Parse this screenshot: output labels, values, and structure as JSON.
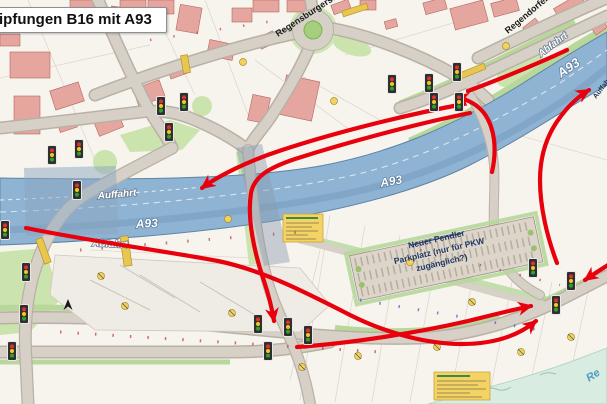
{
  "title": "ipfungen B16 mit A93",
  "highway_labels": {
    "a93_left": "A93",
    "a93_mid": "A93",
    "a93_topright": "A93"
  },
  "ramp_labels": {
    "auffahrt_left": "Auffahrt",
    "abfahrt_left": "Abfahrt",
    "abfahrt_topright": "Abfahrt",
    "auffahrt_right": "Auffahrt"
  },
  "street_labels": {
    "regensburgerstr": "Regensburgerstr.",
    "regendorferstr": "Regendorferstr."
  },
  "parkplatz": {
    "line1": "Neuer Pendler",
    "line2": "Parkplatz (nur für PKW",
    "line3": "zugänglich?)"
  },
  "river_label": "Re",
  "colors": {
    "arrow_red": "#e8000d",
    "highway_blue": "#8fb3d3",
    "building_pink": "#e4a69e",
    "green": "#cbe3ad",
    "road_gray": "#d6d0c7",
    "river": "#d9ece2",
    "legend_yellow": "#f2d363",
    "traffic_red": "#e03131",
    "traffic_yellow": "#f2c81e",
    "traffic_green": "#2fa12f"
  },
  "traffic_lights": [
    [
      52,
      155
    ],
    [
      79,
      149
    ],
    [
      161,
      106
    ],
    [
      169,
      132
    ],
    [
      184,
      102
    ],
    [
      77,
      190
    ],
    [
      5,
      230
    ],
    [
      26,
      272
    ],
    [
      24,
      314
    ],
    [
      12,
      351
    ],
    [
      258,
      324
    ],
    [
      288,
      327
    ],
    [
      308,
      335
    ],
    [
      268,
      351
    ],
    [
      533,
      268
    ],
    [
      571,
      281
    ],
    [
      556,
      305
    ],
    [
      392,
      84
    ],
    [
      429,
      83
    ],
    [
      457,
      72
    ],
    [
      434,
      102
    ],
    [
      459,
      102
    ]
  ]
}
